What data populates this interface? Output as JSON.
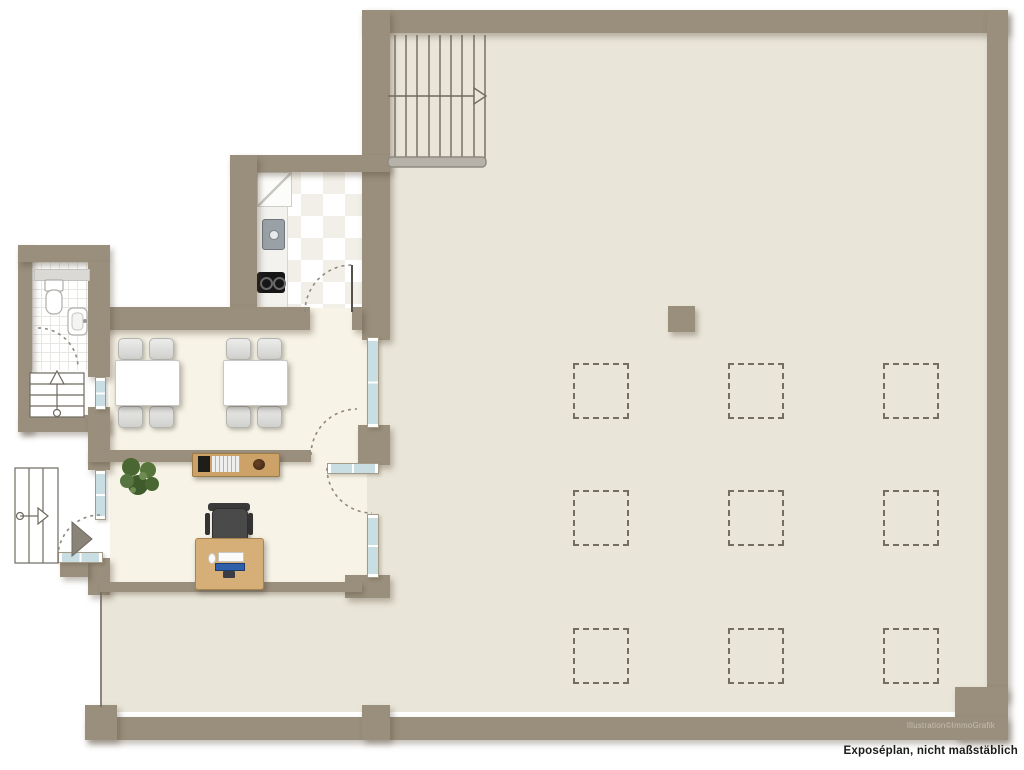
{
  "document": {
    "kind": "real-estate floor plan (Exposéplan)",
    "caption": "Exposéplan, nicht maßstäblich",
    "watermark": "Illustration©ImmoGrafik"
  },
  "palette": {
    "wall": "#9a8e7c",
    "hall_floor": "#e9e5d8",
    "room_floor": "#f7f3e6",
    "window_glass": "#c9dee3",
    "marker_dash": "#746e62",
    "wood": "#d6ae78",
    "caption_text": "#1b1b19",
    "watermark_text": "#c6bfb1"
  },
  "plan": {
    "rooms": [
      {
        "name": "main-hall",
        "features": [
          "straight staircase with up-arrow",
          "square column",
          "nine dashed floor markers in 3x3 grid"
        ]
      },
      {
        "name": "kitchen",
        "features": [
          "checkered tile floor",
          "counter strip",
          "fridge cabinet",
          "sink",
          "two-burner stove",
          "door with swing arc"
        ]
      },
      {
        "name": "dining-room",
        "features": [
          "two tables",
          "eight chairs",
          "window left",
          "glazed partition to hall"
        ]
      },
      {
        "name": "office",
        "features": [
          "desk with monitor and keyboard",
          "office chair",
          "sideboard with books and bowl",
          "potted plant",
          "glazed door to hall",
          "window"
        ]
      },
      {
        "name": "bathroom",
        "features": [
          "tiled floor",
          "toilet",
          "washbasin",
          "door swing arc",
          "small window strip"
        ]
      },
      {
        "name": "entrance",
        "features": [
          "entrance door with swing arc",
          "threshold",
          "side staircase with arrow",
          "landing stairs with up arrow"
        ]
      }
    ],
    "floor_markers": {
      "rows": 3,
      "cols": 3,
      "count": 9
    }
  }
}
